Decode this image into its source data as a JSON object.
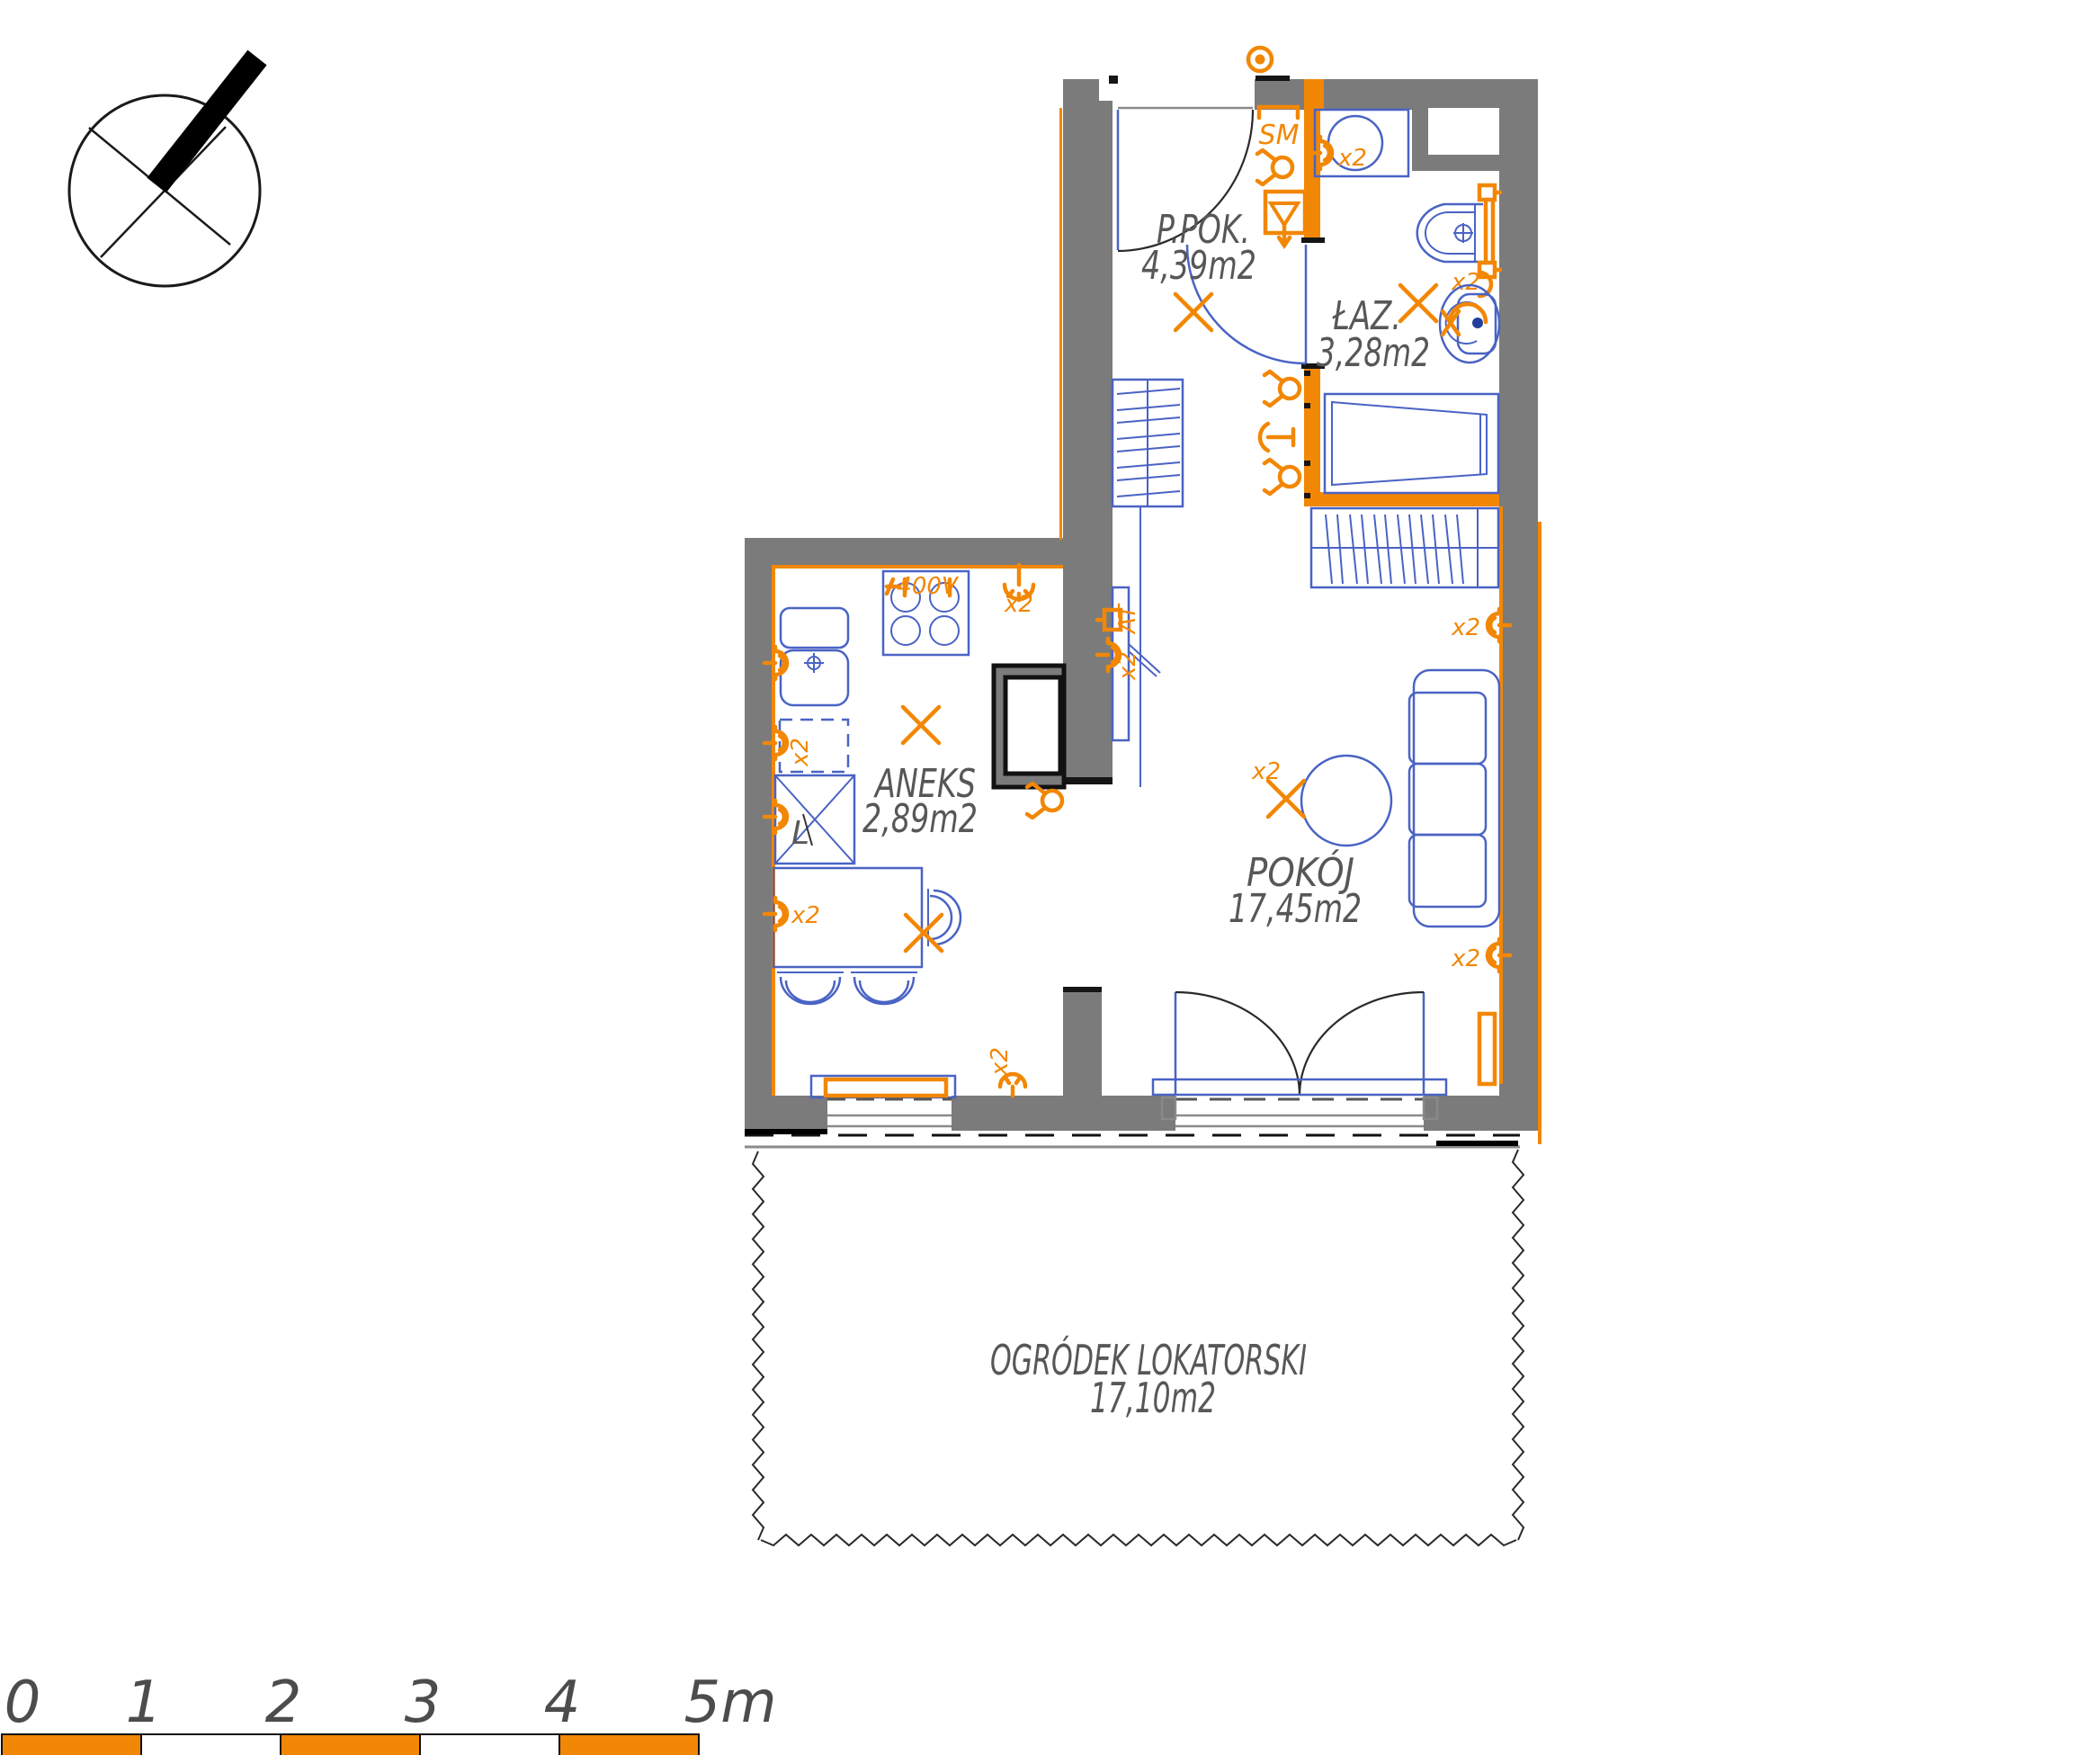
{
  "plan_title": "apartment-floor-plan",
  "rooms": {
    "hall": {
      "name": "P.POK.",
      "area": "4,39m2"
    },
    "bathroom": {
      "name": "ŁAZ.",
      "area": "3,28m2"
    },
    "kitchenette": {
      "name": "ANEKS",
      "area": "2,89m2"
    },
    "living_room": {
      "name": "POKÓJ",
      "area": "17,45m2"
    },
    "garden": {
      "name": "OGRÓDEK LOKATORSKI",
      "area": "17,10m2"
    }
  },
  "annotations": {
    "smoke_detector": "SM",
    "power_3phase": "400V",
    "double_count": "x2",
    "fridge_letter": "L",
    "antenna": "AT"
  },
  "scale_bar": {
    "unit_labels": [
      "0",
      "1",
      "2",
      "3",
      "4",
      "5m"
    ]
  },
  "colors": {
    "wall_fill": "#7b7b7b",
    "accent_orange": "#F28705",
    "furniture_blue": "#4a63c4",
    "label_text": "#57575a"
  }
}
